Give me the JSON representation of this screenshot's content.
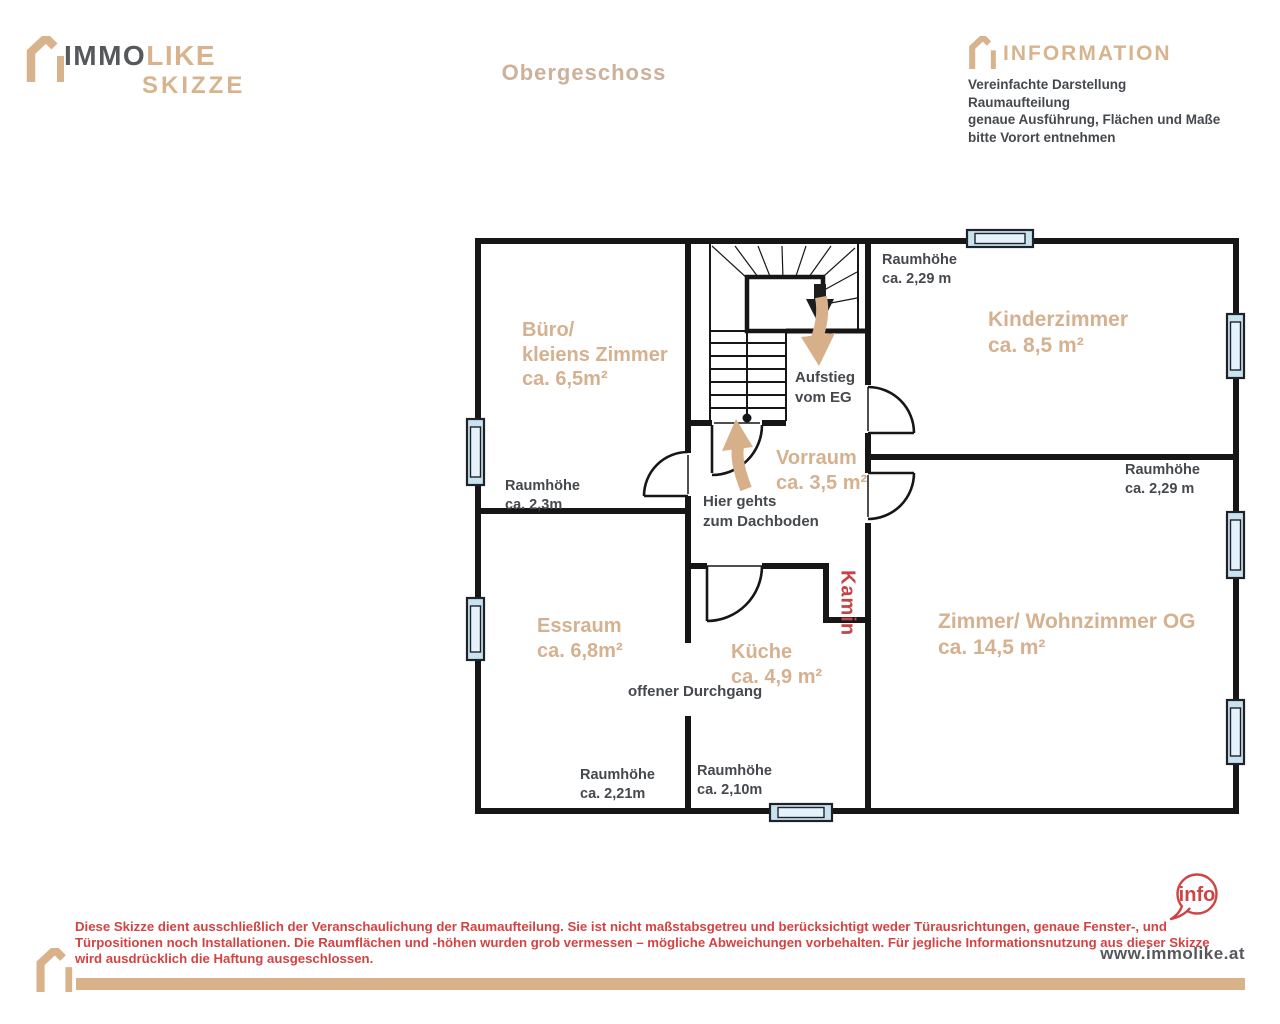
{
  "header": {
    "logo_line1_dark": "IMMO",
    "logo_line1_tan": "LIKE",
    "logo_line2": "SKIZZE",
    "title": "Obergeschoss",
    "info_title": "INFORMATION",
    "info_lines": [
      "Vereinfachte Darstellung",
      "Raumaufteilung",
      "genaue Ausführung, Flächen und Maße",
      "bitte Vorort entnehmen"
    ]
  },
  "plan": {
    "labels": {
      "buero": [
        "Büro/",
        "kleiens Zimmer",
        "ca. 6,5m²"
      ],
      "buero_height": [
        "Raumhöhe",
        "ca. 2,3m"
      ],
      "kinderzimmer": [
        "Kinderzimmer",
        "ca. 8,5 m²"
      ],
      "kinderzimmer_height": [
        "Raumhöhe",
        "ca. 2,29 m"
      ],
      "aufstieg": [
        "Aufstieg",
        "vom EG"
      ],
      "vorraum": [
        "Vorraum",
        "ca. 3,5 m²"
      ],
      "dachboden": [
        "Hier gehts",
        "zum Dachboden"
      ],
      "wohnzimmer_height": [
        "Raumhöhe",
        "ca. 2,29 m"
      ],
      "essraum": [
        "Essraum",
        "ca. 6,8m²"
      ],
      "kueche": [
        "Küche",
        "ca. 4,9 m²"
      ],
      "durchgang": "offener Durchgang",
      "kamin": "Kamin",
      "wohnzimmer": [
        "Zimmer/ Wohnzimmer OG",
        "ca. 14,5 m²"
      ],
      "essraum_height": [
        "Raumhöhe",
        "ca. 2,21m"
      ],
      "kueche_height": [
        "Raumhöhe",
        "ca. 2,10m"
      ]
    }
  },
  "footer": {
    "disclaimer_lines": [
      "Diese Skizze dient ausschließlich der Veranschaulichung der Raumaufteilung. Sie ist nicht maßstabsgetreu und berücksichtigt weder Türausrichtungen, genaue Fenster-, und",
      "Türpositionen  noch Installationen. Die Raumflächen und -höhen wurden grob vermessen – mögliche Abweichungen vorbehalten.  Für jegliche Informationsnutzung aus dieser Skizze",
      "wird ausdrücklich die Haftung ausgeschlossen."
    ],
    "info_badge": "info",
    "website": "www.immolike.at"
  },
  "colors": {
    "accent_tan": "#d6b190",
    "logo_tan": "#d8b48e",
    "logo_gray": "#56585c",
    "wall_black": "#161616",
    "window_blue": "#cfe7f2",
    "disclaimer_red": "#d54242",
    "kamin_red": "#c84444",
    "text_dark": "#45484d",
    "footer_bar_tan": "#d9b28a"
  }
}
